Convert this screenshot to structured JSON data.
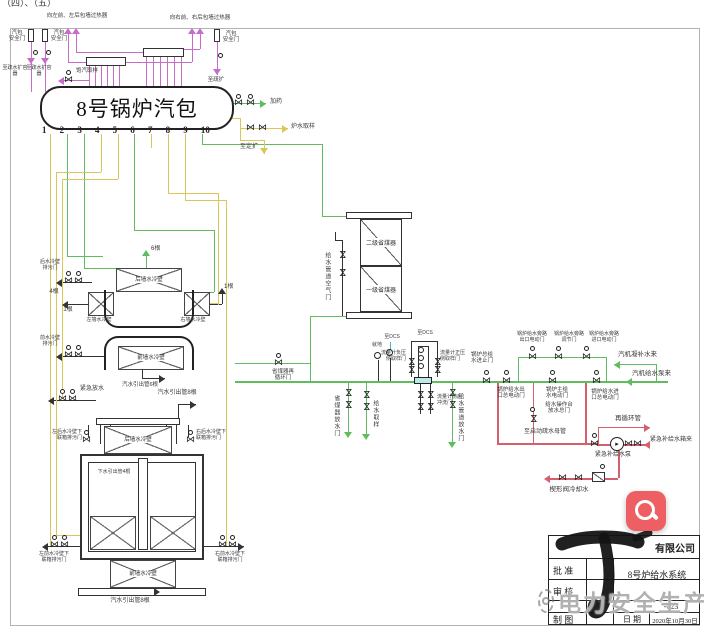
{
  "page": {
    "corner_fragment": "（四）、（五）"
  },
  "drum": {
    "title": "8号锅炉汽包",
    "numbers": [
      "1",
      "2",
      "3",
      "4",
      "5",
      "6",
      "7",
      "8",
      "9",
      "10"
    ]
  },
  "top": {
    "to_left_wall": "向左前、左后包墙过热器",
    "to_right_wall": "向右前、右后包墙过热器",
    "safety_valve_l1": "汽包\n安全门",
    "safety_valve_l2": "汽包\n安全门",
    "safety_valve_r": "汽包\n安全门",
    "drain_l1": "至疏水扩容器",
    "drain_l2": "至疏水扩容器",
    "drain_r": "至疏扩",
    "steam_sample": "饱汽取样"
  },
  "drum_right": {
    "dosing": "加药",
    "water_sample": "炉水取样",
    "to_blowdown": "至定扩"
  },
  "economizer": {
    "stage2": "二级省煤器",
    "stage1": "一级省煤器",
    "air_valve": "给水管道空气门"
  },
  "feed_line": {
    "recirc": "省煤器再\n循环门",
    "econ_drain": "省煤器放水门",
    "fw_sample": "给水取样",
    "local": "就地",
    "to_dcs1": "至DCS",
    "to_dcs2": "至DCS",
    "fm_neg": "流量计负压\n侧取样门",
    "fm_pos": "流量计正压\n侧取样门",
    "fm_flush": "流量计前后\n冲洗门",
    "pipe_drain": "给水管道放水门",
    "main_stop": "锅炉总给\n水进止门",
    "outlet_mov": "锅炉给水出\n口总电动门",
    "main_mov": "锅炉主给\n水电动门",
    "inlet_mov": "锅炉给水进\n口总电动门",
    "bypass_out": "锅炉给水旁路\n出口电动门",
    "bypass_ctrl": "锅炉给水旁路\n调节门",
    "bypass_in": "锅炉给水旁路\n进口电动门",
    "station_drain": "给水操作台\n放水总门",
    "to_startup": "至启动疏水母管",
    "cond_makeup": "汽机凝补水来",
    "from_pump": "汽机给水泵来"
  },
  "emergency": {
    "recirc_pipe": "再循环管",
    "from_tank": "紧急补给水箱来",
    "pump": "紧急补给水泵",
    "cooling": "楔形阀冷却水"
  },
  "upper_walls": {
    "n6": "6根",
    "n1a": "1根",
    "n1b": "1根",
    "n4": "4根",
    "top": "后墙水冷壁",
    "left": "左墙水冷壁",
    "right": "右墙水冷壁",
    "bottom": "前墙水冷壁",
    "blowdown_rear": "后水冷壁\n排污门",
    "blowdown_front": "前水冷壁\n排污门",
    "outlet": "汽水引出管6根"
  },
  "lower_walls": {
    "emerg_drain": "紧急放水",
    "outlet_top": "汽水引出管8根",
    "header": "后墙水冷壁",
    "hdr_left": "左后水冷壁下\n联箱排污门",
    "hdr_right": "右后水冷壁下\n联箱排污门",
    "downcomer": "下水引出管4根",
    "front": "前墙水冷壁",
    "front_left": "左前水冷壁下\n联箱排污门",
    "front_right": "右前水冷壁下\n联箱排污门",
    "outlet_bottom": "汽水引出管8根"
  },
  "title_block": {
    "company": "有限公司",
    "approve": "批 准",
    "review": "审 核",
    "draft": "制 图",
    "date_label": "日 期",
    "date": "2020年10月30日",
    "system": "8号炉给水系统",
    "number": "-023"
  },
  "watermark": {
    "text": "电力安全生产"
  },
  "colors": {
    "pipe_yellow": "#d9c75a",
    "pipe_green": "#61bb61",
    "pipe_magenta": "#c76cc7",
    "pipe_red": "#d4606e",
    "pipe_cyan": "#49b8b8",
    "button_red": "#ee5f63"
  },
  "icons": {
    "search": "magnifier",
    "valve": "⋈"
  }
}
